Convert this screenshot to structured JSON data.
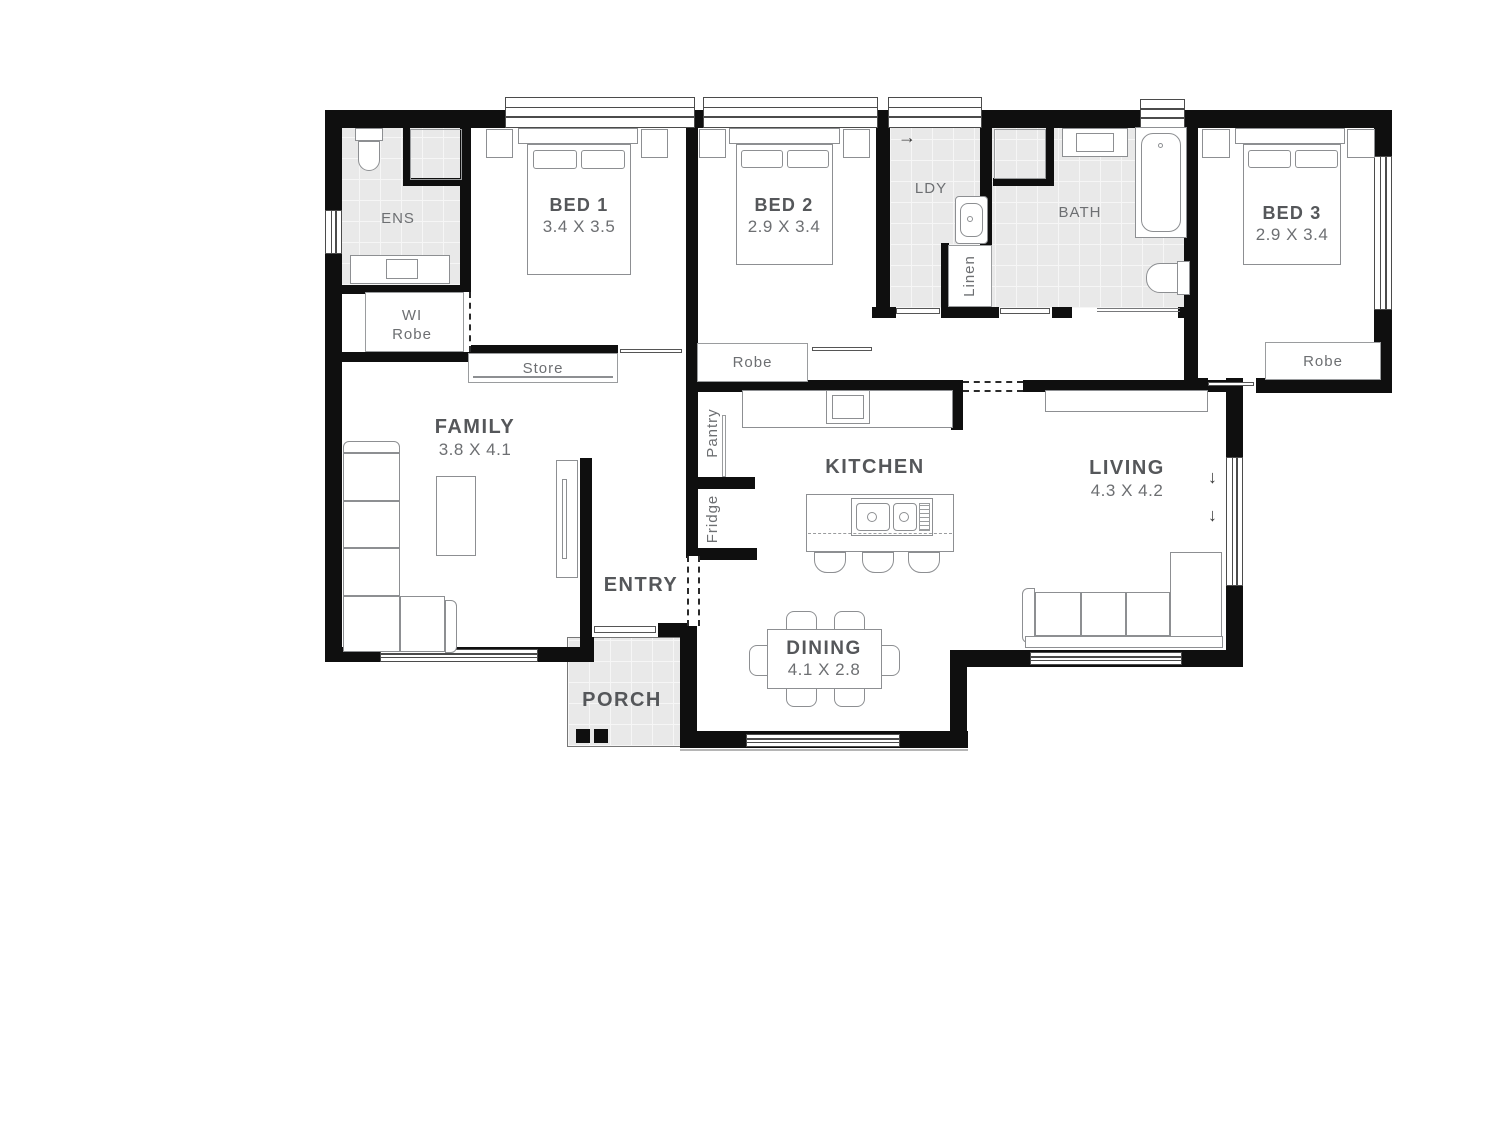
{
  "plan_title": "Three bedroom single storey floor plan",
  "colors": {
    "wall": "#0f0f0f",
    "tile": "#e9e9e9",
    "furniture_line": "#8d8f92",
    "label": "#55575a",
    "dim_label": "#6d6f72"
  },
  "rooms": {
    "ens": {
      "name": "ENS"
    },
    "wi_robe": {
      "line1": "WI",
      "line2": "Robe"
    },
    "bed1": {
      "name": "BED 1",
      "dims": "3.4 X 3.5"
    },
    "store": {
      "name": "Store"
    },
    "bed2": {
      "name": "BED 2",
      "dims": "2.9 X 3.4"
    },
    "robe_bed2": {
      "name": "Robe"
    },
    "ldy": {
      "name": "LDY"
    },
    "linen": {
      "name": "Linen"
    },
    "bath": {
      "name": "BATH"
    },
    "bed3": {
      "name": "BED 3",
      "dims": "2.9 X 3.4"
    },
    "robe_bed3": {
      "name": "Robe"
    },
    "family": {
      "name": "FAMILY",
      "dims": "3.8 X 4.1"
    },
    "entry": {
      "name": "ENTRY"
    },
    "pantry": {
      "name": "Pantry"
    },
    "fridge": {
      "name": "Fridge"
    },
    "kitchen": {
      "name": "KITCHEN"
    },
    "living": {
      "name": "LIVING",
      "dims": "4.3 X 4.2"
    },
    "dining": {
      "name": "DINING",
      "dims": "4.1 X 2.8"
    },
    "porch": {
      "name": "PORCH"
    }
  },
  "symbols": {
    "slide_door_arrow": "→",
    "window_slide_arrow": "↓"
  }
}
